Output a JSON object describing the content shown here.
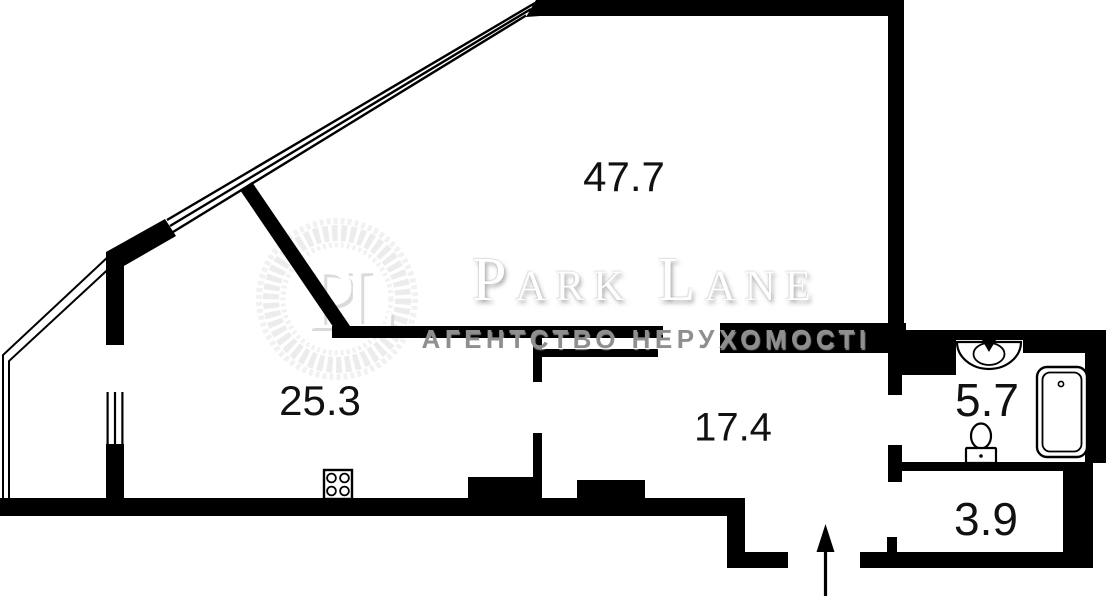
{
  "watermark": {
    "monogram": "PL",
    "brand": "Park Lane",
    "subtitle": "АГЕНТСТВО НЕРУХОМОСТІ"
  },
  "rooms": [
    {
      "area": "47.7"
    },
    {
      "area": "25.3"
    },
    {
      "area": "17.4"
    },
    {
      "area": "5.7"
    },
    {
      "area": "3.9"
    }
  ],
  "entrance": {
    "direction": "up"
  },
  "colors": {
    "wall": "#000000",
    "background": "#ffffff",
    "watermark_grey": "#8f8f8f"
  }
}
